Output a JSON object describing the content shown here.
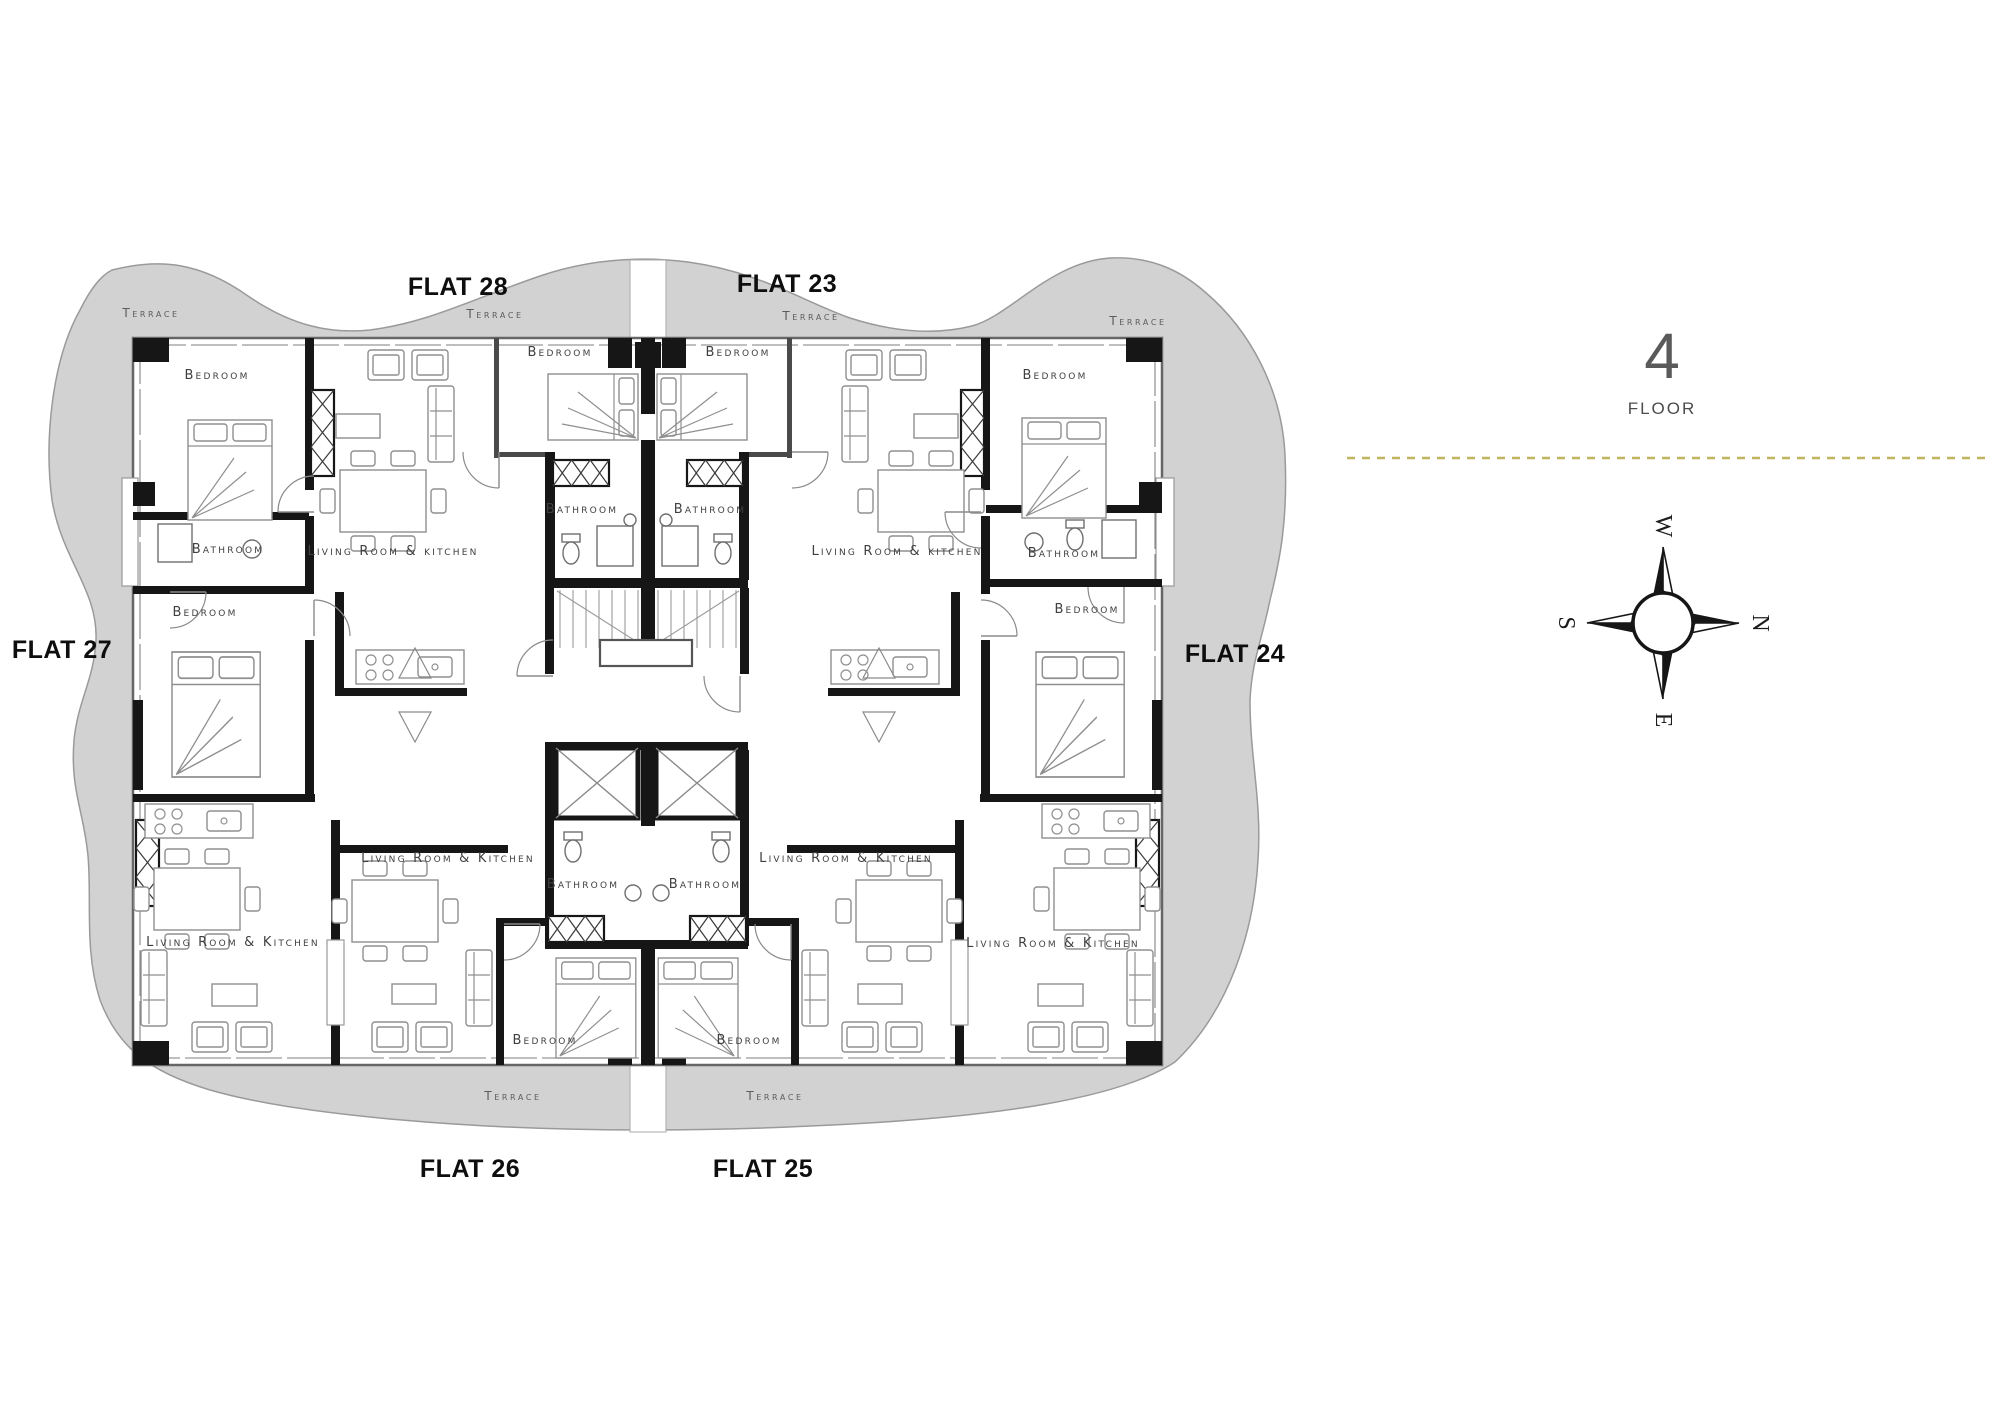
{
  "floor_panel": {
    "number": "4",
    "label": "FLOOR",
    "divider_color": "#c0b45e"
  },
  "compass": {
    "top": "W",
    "right": "N",
    "bottom": "E",
    "left": "S"
  },
  "plan": {
    "flat_labels": [
      {
        "text": "FLAT 28",
        "x": 458,
        "y": 295
      },
      {
        "text": "FLAT 23",
        "x": 787,
        "y": 292
      },
      {
        "text": "FLAT 27",
        "x": 62,
        "y": 658
      },
      {
        "text": "FLAT 24",
        "x": 1235,
        "y": 662
      },
      {
        "text": "FLAT 26",
        "x": 470,
        "y": 1177
      },
      {
        "text": "FLAT 25",
        "x": 763,
        "y": 1177
      }
    ],
    "room_labels": [
      {
        "text": "Terrace",
        "x": 151,
        "y": 317,
        "cls": "terrace-label"
      },
      {
        "text": "Terrace",
        "x": 495,
        "y": 318,
        "cls": "terrace-label"
      },
      {
        "text": "Terrace",
        "x": 811,
        "y": 320,
        "cls": "terrace-label"
      },
      {
        "text": "Terrace",
        "x": 1138,
        "y": 325,
        "cls": "terrace-label"
      },
      {
        "text": "Terrace",
        "x": 513,
        "y": 1100,
        "cls": "terrace-label"
      },
      {
        "text": "Terrace",
        "x": 775,
        "y": 1100,
        "cls": "terrace-label"
      },
      {
        "text": "Bedroom",
        "x": 217,
        "y": 379,
        "cls": "room-label"
      },
      {
        "text": "Bedroom",
        "x": 560,
        "y": 356,
        "cls": "room-label"
      },
      {
        "text": "Bedroom",
        "x": 738,
        "y": 356,
        "cls": "room-label"
      },
      {
        "text": "Bedroom",
        "x": 1055,
        "y": 379,
        "cls": "room-label"
      },
      {
        "text": "Bedroom",
        "x": 205,
        "y": 616,
        "cls": "room-label"
      },
      {
        "text": "Bedroom",
        "x": 1087,
        "y": 613,
        "cls": "room-label"
      },
      {
        "text": "Bedroom",
        "x": 545,
        "y": 1044,
        "cls": "room-label"
      },
      {
        "text": "Bedroom",
        "x": 749,
        "y": 1044,
        "cls": "room-label"
      },
      {
        "text": "Bathroom",
        "x": 228,
        "y": 553,
        "cls": "room-label"
      },
      {
        "text": "Bathroom",
        "x": 582,
        "y": 513,
        "cls": "room-label"
      },
      {
        "text": "Bathroom",
        "x": 710,
        "y": 513,
        "cls": "room-label"
      },
      {
        "text": "Bathroom",
        "x": 1064,
        "y": 557,
        "cls": "room-label"
      },
      {
        "text": "Bathroom",
        "x": 583,
        "y": 888,
        "cls": "room-label"
      },
      {
        "text": "Bathroom",
        "x": 705,
        "y": 888,
        "cls": "room-label"
      },
      {
        "text": "Living Room & kitchen",
        "x": 393,
        "y": 555,
        "cls": "room-label"
      },
      {
        "text": "Living Room & kitchen",
        "x": 897,
        "y": 555,
        "cls": "room-label"
      },
      {
        "text": "Living Room & Kitchen",
        "x": 233,
        "y": 946,
        "cls": "room-label"
      },
      {
        "text": "Living Room & Kitchen",
        "x": 1053,
        "y": 947,
        "cls": "room-label"
      },
      {
        "text": "Living Room & Kitchen",
        "x": 448,
        "y": 862,
        "cls": "room-label"
      },
      {
        "text": "Living Room & Kitchen",
        "x": 846,
        "y": 862,
        "cls": "room-label"
      }
    ]
  }
}
